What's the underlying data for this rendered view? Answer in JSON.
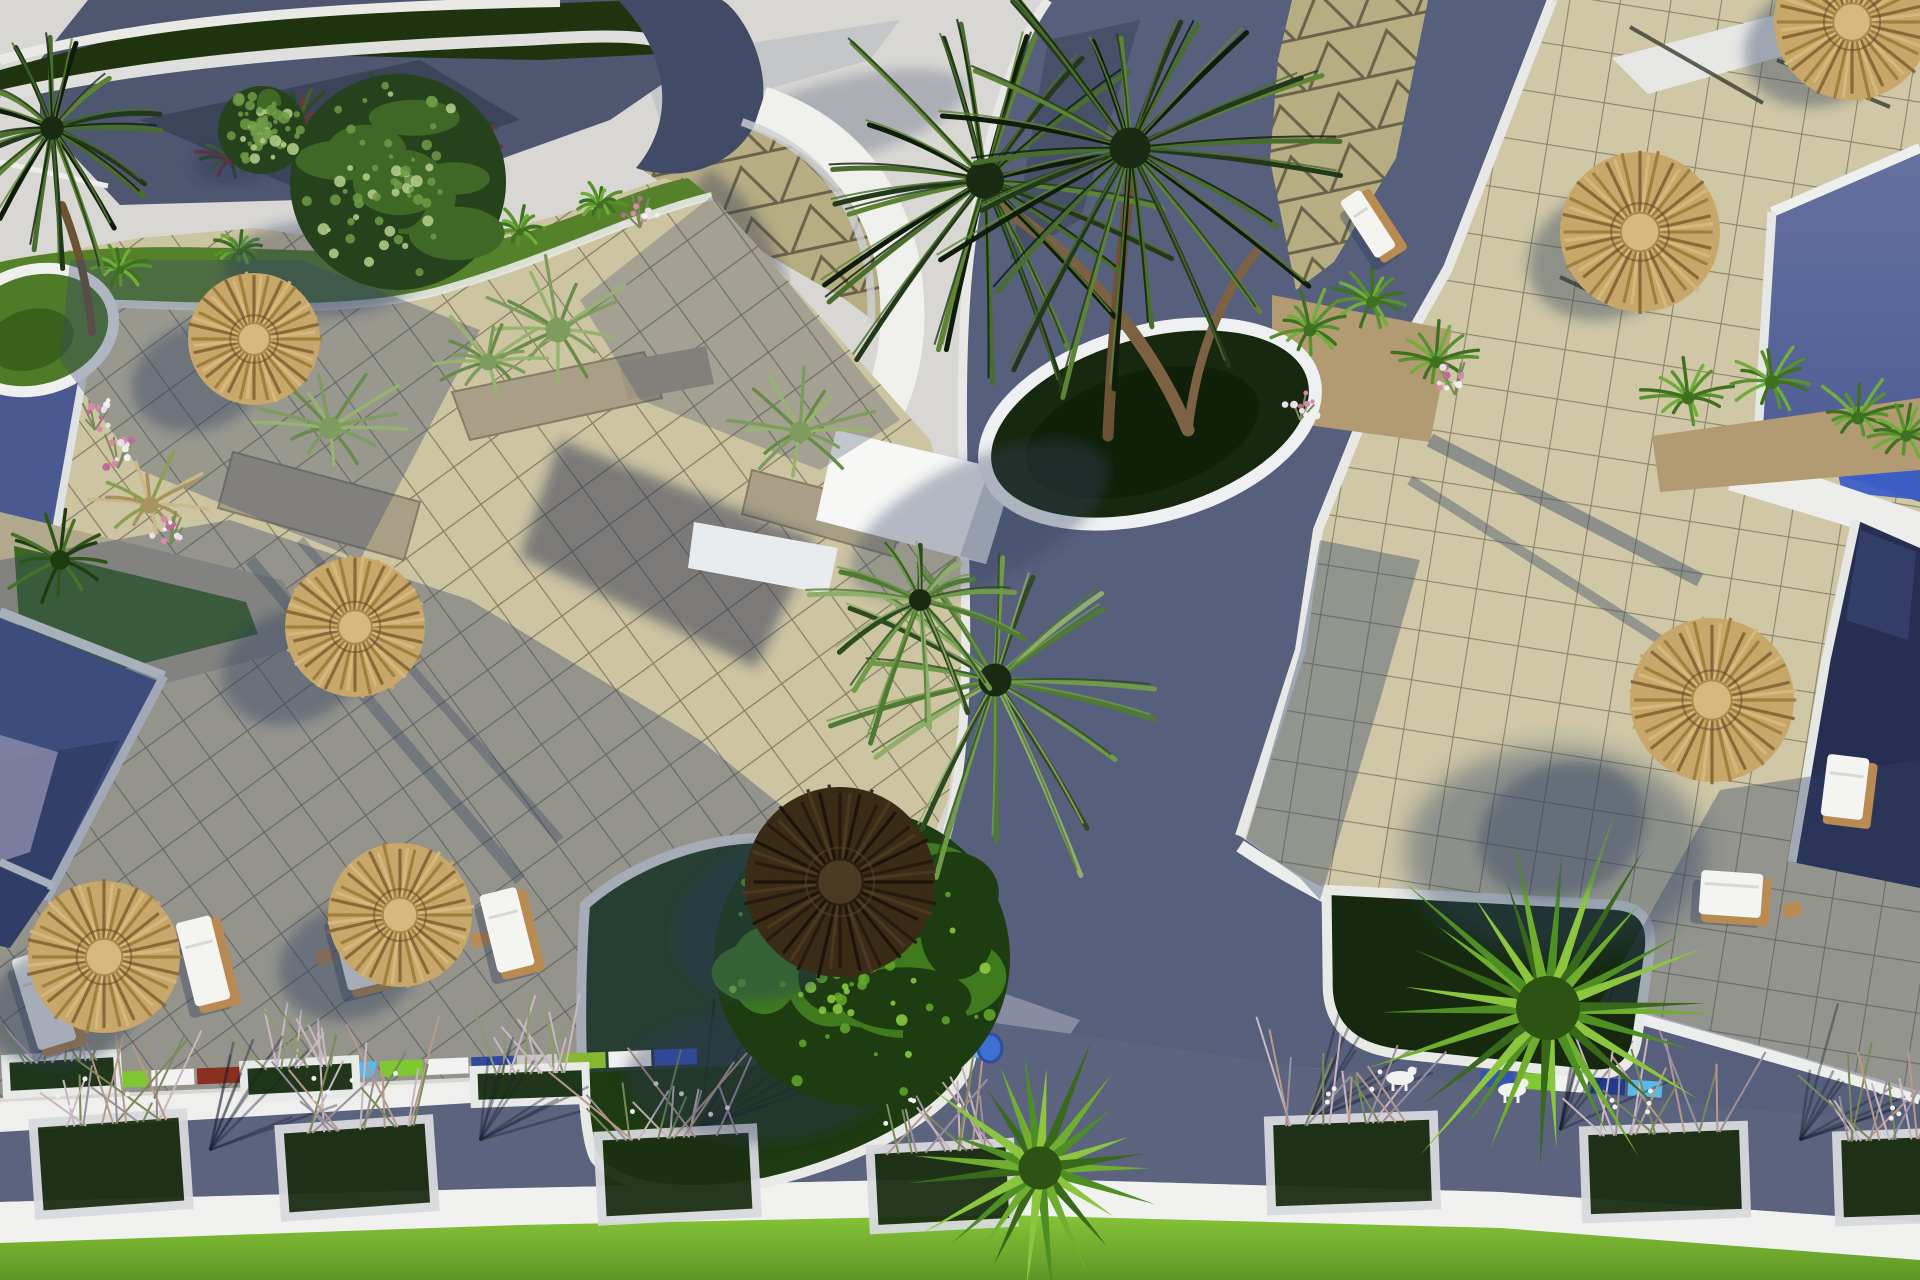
{
  "scene": {
    "title": "Aerial 3D render of a resort pool terrace with straw umbrellas, palms and planters",
    "palette": {
      "sky_bright": "#d8d7d3",
      "plaza_tile_sun": "#cdc4a2",
      "plaza_tile_right": "#cfc7a6",
      "tile_grid_line": "#4a4632",
      "triangle_paving": "#b7ad83",
      "path_dark": "#4e5670",
      "road": "#59617c",
      "pool_light": "#5d6ca6",
      "pool_mid": "#46588f",
      "pool_dark": "#262e52",
      "pool_reflection": "#3b5ec6",
      "white_deck": "#f0f0ed",
      "grass_sun": "#55812a",
      "grass_dark": "#1d3a10",
      "lawn": "#79b433",
      "straw": "#c2a166",
      "straw_dark": "#2a1d10",
      "stone": "#a89f86",
      "lavender_deck": "#b5abc6",
      "shadow": "rgba(45,60,95,0.4)"
    },
    "umbrellas": [
      {
        "x": 254,
        "y": 339,
        "r": 66,
        "kind": "straw",
        "sx": -55,
        "sy": 38
      },
      {
        "x": 355,
        "y": 627,
        "r": 70,
        "kind": "straw",
        "sx": -62,
        "sy": 40
      },
      {
        "x": 104,
        "y": 957,
        "r": 76,
        "kind": "straw",
        "sx": -40,
        "sy": 48
      },
      {
        "x": 400,
        "y": 915,
        "r": 72,
        "kind": "straw",
        "sx": -48,
        "sy": 46
      },
      {
        "x": 840,
        "y": 882,
        "r": 95,
        "kind": "dark",
        "sx": -70,
        "sy": 40
      },
      {
        "x": 1712,
        "y": 700,
        "r": 82,
        "kind": "straw",
        "sx": -150,
        "sy": 130
      },
      {
        "x": 1640,
        "y": 232,
        "r": 80,
        "kind": "straw",
        "sx": -30,
        "sy": 22
      },
      {
        "x": 1852,
        "y": 22,
        "r": 78,
        "kind": "straw",
        "sx": -28,
        "sy": 20
      }
    ],
    "lounge_chairs": [
      {
        "x": 24,
        "y": 952,
        "w": 40,
        "h": 95,
        "rot": -17
      },
      {
        "x": 185,
        "y": 918,
        "w": 36,
        "h": 86,
        "rot": -14
      },
      {
        "x": 338,
        "y": 906,
        "w": 36,
        "h": 82,
        "rot": -14
      },
      {
        "x": 488,
        "y": 890,
        "w": 38,
        "h": 80,
        "rot": -14
      },
      {
        "x": 1824,
        "y": 756,
        "w": 42,
        "h": 62,
        "rot": 7
      },
      {
        "x": 1700,
        "y": 872,
        "w": 62,
        "h": 44,
        "rot": 4
      },
      {
        "x": 1356,
        "y": 190,
        "w": 24,
        "h": 68,
        "rot": -33
      }
    ],
    "side_tables": [
      [
        150,
        978
      ],
      [
        315,
        952
      ],
      [
        470,
        935
      ],
      [
        1782,
        905
      ]
    ],
    "road_planters": [
      {
        "x": 36,
        "y": 1118,
        "w": 150,
        "h": 92,
        "rot": -4
      },
      {
        "x": 282,
        "y": 1124,
        "w": 150,
        "h": 88,
        "rot": -4
      },
      {
        "x": 600,
        "y": 1132,
        "w": 155,
        "h": 85,
        "rot": -3
      },
      {
        "x": 872,
        "y": 1146,
        "w": 140,
        "h": 80,
        "rot": -3
      },
      {
        "x": 1270,
        "y": 1118,
        "w": 165,
        "h": 90,
        "rot": -2
      },
      {
        "x": 1585,
        "y": 1128,
        "w": 160,
        "h": 88,
        "rot": -2
      },
      {
        "x": 1838,
        "y": 1134,
        "w": 110,
        "h": 86,
        "rot": -2
      }
    ],
    "upper_planters": [
      {
        "x": 2,
        "y": 1052,
        "w": 120,
        "h": 44,
        "rot": -3
      },
      {
        "x": 240,
        "y": 1058,
        "w": 120,
        "h": 42,
        "rot": -3
      },
      {
        "x": 470,
        "y": 1064,
        "w": 120,
        "h": 42,
        "rot": -2
      }
    ],
    "mosaic_strips": [
      {
        "x1": 60,
        "y1": 1082,
        "x2": 700,
        "y2": 1056,
        "colors": [
          "#4a6fd4",
          "#7ec832",
          "#f2f2f2",
          "#8a2f1f",
          "#3553b8",
          "#f2f2f2",
          "#59b9e8",
          "#7ec832",
          "#f2f2f2",
          "#2f49a0",
          "#c8c8c8",
          "#88b830",
          "#f2f2f2",
          "#3553b8"
        ]
      },
      {
        "x1": 838,
        "y1": 1060,
        "x2": 1000,
        "y2": 1048,
        "colors": [
          "#3553b8",
          "#e8c020",
          "#7ec832",
          "#8a2f1f",
          "#203a8c",
          "#59b9e8"
        ]
      },
      {
        "x1": 1480,
        "y1": 1078,
        "x2": 1665,
        "y2": 1090,
        "colors": [
          "#3553b8",
          "#7ec832",
          "#f2f2f2",
          "#203a8c",
          "#59b9e8"
        ]
      }
    ],
    "pole_shadows": [
      [
        1630,
        27,
        1763,
        103
      ],
      [
        1777,
        60,
        1890,
        107
      ],
      [
        1560,
        277,
        1627,
        308
      ],
      [
        1648,
        748,
        1705,
        716
      ]
    ],
    "branch_shadow_anchors": [
      [
        210,
        1150
      ],
      [
        480,
        1140
      ],
      [
        700,
        1128
      ],
      [
        1310,
        1120
      ],
      [
        1560,
        1130
      ],
      [
        1800,
        1140
      ]
    ],
    "trees": [
      {
        "x": 398,
        "y": 182,
        "r": 108,
        "pal": "dark"
      },
      {
        "x": 262,
        "y": 130,
        "r": 44,
        "pal": "dark"
      },
      {
        "x": 862,
        "y": 958,
        "r": 148,
        "pal": "bright"
      }
    ],
    "palms": [
      {
        "x": 985,
        "y": 180,
        "r": 190,
        "n": 24,
        "pal": "dark"
      },
      {
        "x": 1130,
        "y": 148,
        "r": 205,
        "n": 26,
        "pal": "dark"
      },
      {
        "x": 52,
        "y": 128,
        "r": 118,
        "n": 18,
        "pal": "dark"
      },
      {
        "x": 995,
        "y": 680,
        "r": 165,
        "n": 18,
        "pal": "mid"
      },
      {
        "x": 920,
        "y": 600,
        "r": 110,
        "n": 14,
        "pal": "mid"
      }
    ],
    "fan_palms": [
      {
        "x": 1040,
        "y": 1168,
        "r": 135,
        "n": 24
      },
      {
        "x": 1548,
        "y": 1008,
        "r": 200,
        "n": 28
      }
    ],
    "tufts": [
      [
        330,
        428,
        78,
        "pale"
      ],
      [
        558,
        330,
        88,
        "pale"
      ],
      [
        488,
        362,
        60,
        "pale"
      ],
      [
        800,
        432,
        75,
        "pale"
      ],
      [
        1310,
        330,
        46,
        "green"
      ],
      [
        1372,
        302,
        42,
        "green"
      ],
      [
        1436,
        362,
        44,
        "green"
      ],
      [
        1688,
        398,
        46,
        "green"
      ],
      [
        1772,
        382,
        50,
        "green"
      ],
      [
        1858,
        418,
        46,
        "green"
      ],
      [
        1906,
        436,
        40,
        "green"
      ],
      [
        60,
        560,
        70,
        "dark"
      ],
      [
        150,
        505,
        60,
        "pampas"
      ],
      [
        300,
        120,
        46,
        "shrub"
      ],
      [
        390,
        105,
        44,
        "shrub"
      ],
      [
        470,
        140,
        40,
        "shrub"
      ],
      [
        230,
        160,
        36,
        "shrub"
      ],
      [
        120,
        270,
        30,
        "green"
      ],
      [
        240,
        252,
        26,
        "green"
      ],
      [
        520,
        232,
        28,
        "green"
      ],
      [
        600,
        205,
        26,
        "green"
      ]
    ],
    "flowers": [
      [
        170,
        545
      ],
      [
        118,
        468
      ],
      [
        95,
        430
      ],
      [
        640,
        228
      ],
      [
        1300,
        420
      ],
      [
        1455,
        395
      ]
    ],
    "animals": [
      [
        1400,
        1078
      ],
      [
        1512,
        1090
      ]
    ],
    "pot": {
      "x": 990,
      "y": 1048
    }
  }
}
